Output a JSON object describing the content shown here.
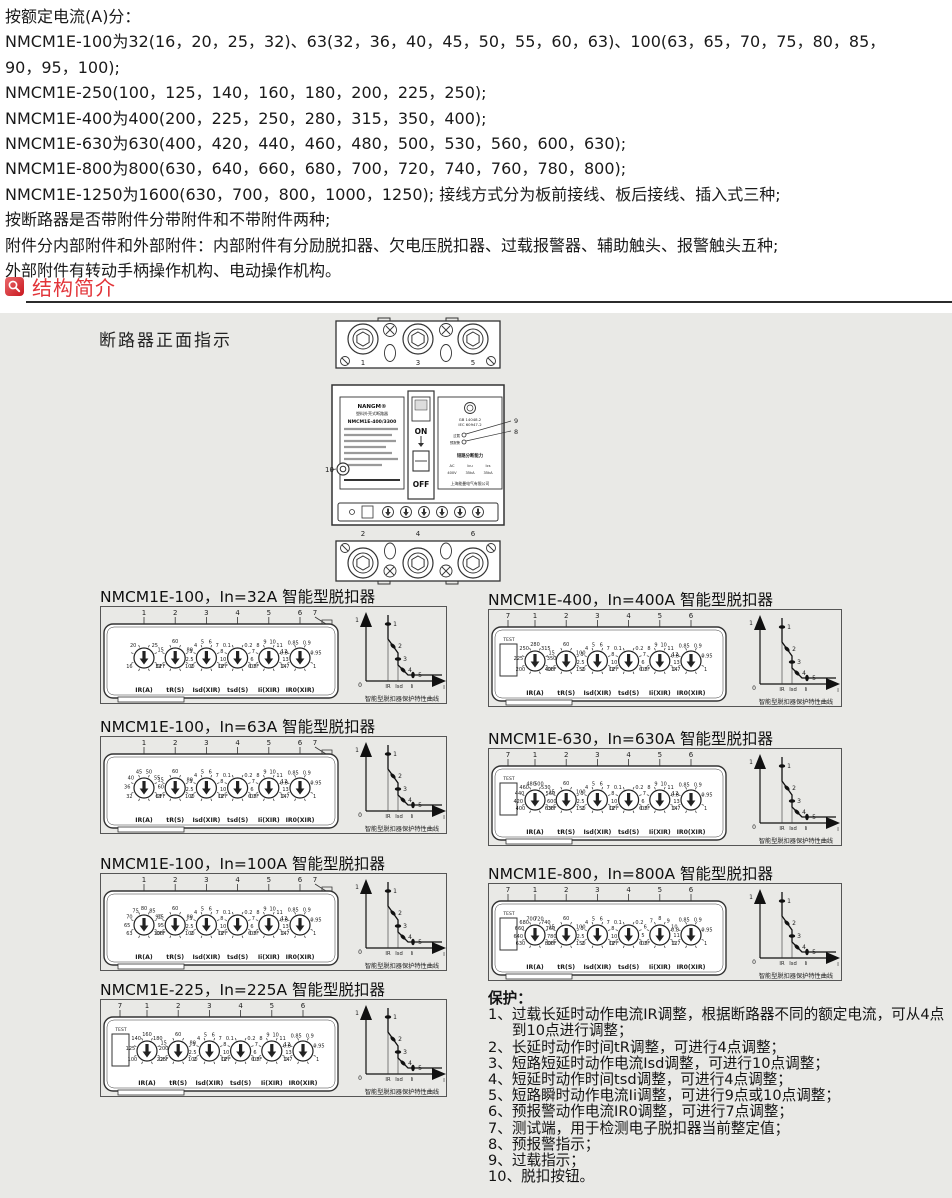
{
  "intro": {
    "lines": [
      "按额定电流(A)分：",
      "NMCM1E-100为32(16，20，25，32)、63(32，36，40，45，50，55，60，63)、100(63，65，70，75，80，85，",
      "90，95，100);",
      "NMCM1E-250(100，125，140，160，180，200，225，250);",
      "NMCM1E-400为400(200，225，250，280，315，350，400);",
      "NMCM1E-630为630(400，420，440，460，480，500，530，560，600，630);",
      "NMCM1E-800为800(630，640，660，680，700，720，740，760，780，800);",
      "NMCM1E-1250为1600(630，700，800，1000，1250); 接线方式分为板前接线、板后接线、插入式三种;",
      "按断路器是否带附件分带附件和不带附件两种;",
      "附件分内部附件和外部附件：内部附件有分励脱扣器、欠电压脱扣器、过载报警器、辅助触头、报警触头五种;",
      "外部附件有转动手柄操作机构、电动操作机构。"
    ]
  },
  "section": {
    "title": "结构简介"
  },
  "gray": {
    "breaker_caption": "断路器正面指示",
    "breaker": {
      "top_terminals": [
        "1",
        "3",
        "5"
      ],
      "bottom_terminals": [
        "2",
        "4",
        "6"
      ],
      "brand": "NANGM®",
      "type_name": "塑料外壳式断路器",
      "model": "NMCM1E-400/3300",
      "on": "ON",
      "off": "OFF",
      "std1": "GB 14048.2",
      "std2": "IEC 60947-2",
      "led_labels": [
        "过载",
        "预报警"
      ],
      "breaking_title": "短路分断能力",
      "breaking_cols": [
        "AC",
        "Icu",
        "Ics"
      ],
      "breaking_vals": [
        "400V",
        "35kA",
        "35kA"
      ],
      "company": "上海能曼电气有限公司",
      "callout_left": "10",
      "callout_right_top": "9",
      "callout_right_bottom": "8"
    },
    "curve": {
      "y_top": "1",
      "origin": "0",
      "x_ticks": [
        "IR",
        "Isd",
        "Ii"
      ],
      "x_label": "I",
      "markers": [
        "1",
        "2",
        "3",
        "4",
        "5"
      ],
      "caption": "智能型脱扣器保护特性曲线"
    },
    "panels": [
      {
        "title": "NMCM1E-100，In=32A 智能型脱扣器",
        "has_test": false,
        "callouts": [
          "1",
          "2",
          "3",
          "4",
          "5",
          "6",
          "7"
        ],
        "dials": [
          {
            "label": "IR(A)",
            "values": [
              "16",
              "20",
              "25",
              "32"
            ]
          },
          {
            "label": "tR(S)",
            "values": [
              "OFF",
              "15",
              "60",
              "80",
              "100"
            ]
          },
          {
            "label": "Isd(XIR)",
            "values": [
              "2",
              "2.5",
              "3",
              "4",
              "5",
              "6",
              "7",
              "8",
              "10",
              "12"
            ]
          },
          {
            "label": "tsd(S)",
            "values": [
              "OFF",
              "0.1",
              "0.2",
              "0.3"
            ]
          },
          {
            "label": "Ii(XIR)",
            "values": [
              "OFF",
              "6",
              "7",
              "8",
              "9",
              "10",
              "11",
              "12",
              "13",
              "14"
            ]
          },
          {
            "label": "IR0(XIR)",
            "values": [
              "0.7",
              "0.8",
              "0.85",
              "0.9",
              "0.95",
              "1"
            ]
          }
        ]
      },
      {
        "title": "NMCM1E-100，In=63A 智能型脱扣器",
        "has_test": false,
        "callouts": [
          "1",
          "2",
          "3",
          "4",
          "5",
          "6",
          "7"
        ],
        "dials": [
          {
            "label": "IR(A)",
            "values": [
              "32",
              "36",
              "40",
              "45",
              "50",
              "55",
              "60",
              "63"
            ]
          },
          {
            "label": "tR(S)",
            "values": [
              "OFF",
              "15",
              "60",
              "80",
              "100"
            ]
          },
          {
            "label": "Isd(XIR)",
            "values": [
              "2",
              "2.5",
              "3",
              "4",
              "5",
              "6",
              "7",
              "8",
              "10",
              "12"
            ]
          },
          {
            "label": "tsd(S)",
            "values": [
              "OFF",
              "0.1",
              "0.2",
              "0.3"
            ]
          },
          {
            "label": "Ii(XIR)",
            "values": [
              "OFF",
              "6",
              "7",
              "8",
              "9",
              "10",
              "11",
              "12",
              "13",
              "14"
            ]
          },
          {
            "label": "IR0(XIR)",
            "values": [
              "0.7",
              "0.8",
              "0.85",
              "0.9",
              "0.95",
              "1"
            ]
          }
        ]
      },
      {
        "title": "NMCM1E-100，In=100A 智能型脱扣器",
        "has_test": false,
        "callouts": [
          "1",
          "2",
          "3",
          "4",
          "5",
          "6",
          "7"
        ],
        "dials": [
          {
            "label": "IR(A)",
            "values": [
              "63",
              "65",
              "70",
              "75",
              "80",
              "85",
              "90",
              "95",
              "100"
            ]
          },
          {
            "label": "tR(S)",
            "values": [
              "OFF",
              "15",
              "60",
              "80",
              "100"
            ]
          },
          {
            "label": "Isd(XIR)",
            "values": [
              "2",
              "2.5",
              "3",
              "4",
              "5",
              "6",
              "7",
              "8",
              "10",
              "12"
            ]
          },
          {
            "label": "tsd(S)",
            "values": [
              "OFF",
              "0.1",
              "0.2",
              "0.3"
            ]
          },
          {
            "label": "Ii(XIR)",
            "values": [
              "OFF",
              "6",
              "7",
              "8",
              "9",
              "10",
              "11",
              "12",
              "13",
              "14"
            ]
          },
          {
            "label": "IR0(XIR)",
            "values": [
              "0.7",
              "0.8",
              "0.85",
              "0.9",
              "0.95",
              "1"
            ]
          }
        ]
      },
      {
        "title": "NMCM1E-225，In=225A 智能型脱扣器",
        "has_test": true,
        "test_label": "TEST",
        "callouts": [
          "7",
          "1",
          "2",
          "3",
          "4",
          "5",
          "6"
        ],
        "dials": [
          {
            "label": "IR(A)",
            "values": [
              "100",
              "125",
              "140",
              "160",
              "180",
              "200",
              "225"
            ]
          },
          {
            "label": "tR(S)",
            "values": [
              "OFF",
              "15",
              "60",
              "80",
              "100"
            ]
          },
          {
            "label": "Isd(XIR)",
            "values": [
              "2",
              "2.5",
              "3",
              "4",
              "5",
              "6",
              "7",
              "8",
              "10",
              "12"
            ]
          },
          {
            "label": "tsd(S)",
            "values": [
              "OFF",
              "0.1",
              "0.2",
              "0.3"
            ]
          },
          {
            "label": "Ii(XIR)",
            "values": [
              "OFF",
              "6",
              "7",
              "8",
              "9",
              "10",
              "11",
              "12",
              "13",
              "14"
            ]
          },
          {
            "label": "IR0(XIR)",
            "values": [
              "0.7",
              "0.8",
              "0.85",
              "0.9",
              "0.95",
              "1"
            ]
          }
        ]
      },
      {
        "title": "NMCM1E-400，In=400A 智能型脱扣器",
        "has_test": true,
        "test_label": "TEST",
        "callouts": [
          "7",
          "1",
          "2",
          "3",
          "4",
          "5",
          "6"
        ],
        "dials": [
          {
            "label": "IR(A)",
            "values": [
              "200",
              "225",
              "250",
              "280",
              "315",
              "350",
              "400"
            ]
          },
          {
            "label": "tR(S)",
            "values": [
              "OFF",
              "15",
              "60",
              "100",
              "150"
            ]
          },
          {
            "label": "Isd(XIR)",
            "values": [
              "2",
              "2.5",
              "3",
              "4",
              "5",
              "6",
              "7",
              "8",
              "10",
              "12"
            ]
          },
          {
            "label": "tsd(S)",
            "values": [
              "OFF",
              "0.1",
              "0.2",
              "0.3"
            ]
          },
          {
            "label": "Ii(XIR)",
            "values": [
              "OFF",
              "6",
              "7",
              "8",
              "9",
              "10",
              "11",
              "12",
              "13",
              "14"
            ]
          },
          {
            "label": "IR0(XIR)",
            "values": [
              "0.7",
              "0.8",
              "0.85",
              "0.9",
              "0.95",
              "1"
            ]
          }
        ]
      },
      {
        "title": "NMCM1E-630，In=630A 智能型脱扣器",
        "has_test": true,
        "test_label": "TEST",
        "callouts": [
          "7",
          "1",
          "2",
          "3",
          "4",
          "5",
          "6"
        ],
        "dials": [
          {
            "label": "IR(A)",
            "values": [
              "400",
              "420",
              "440",
              "460",
              "480",
              "500",
              "530",
              "560",
              "600",
              "630"
            ]
          },
          {
            "label": "tR(S)",
            "values": [
              "OFF",
              "15",
              "60",
              "100",
              "150"
            ]
          },
          {
            "label": "Isd(XIR)",
            "values": [
              "2",
              "2.5",
              "3",
              "4",
              "5",
              "6",
              "7",
              "8",
              "10",
              "12"
            ]
          },
          {
            "label": "tsd(S)",
            "values": [
              "OFF",
              "0.1",
              "0.2",
              "0.3"
            ]
          },
          {
            "label": "Ii(XIR)",
            "values": [
              "OFF",
              "6",
              "7",
              "8",
              "9",
              "10",
              "11",
              "12",
              "13",
              "14"
            ]
          },
          {
            "label": "IR0(XIR)",
            "values": [
              "0.7",
              "0.8",
              "0.85",
              "0.9",
              "0.95",
              "1"
            ]
          }
        ]
      },
      {
        "title": "NMCM1E-800，In=800A 智能型脱扣器",
        "has_test": true,
        "test_label": "TEST",
        "callouts": [
          "7",
          "1",
          "2",
          "3",
          "4",
          "5",
          "6"
        ],
        "dials": [
          {
            "label": "IR(A)",
            "values": [
              "630",
              "640",
              "660",
              "680",
              "700",
              "720",
              "740",
              "760",
              "780",
              "800"
            ]
          },
          {
            "label": "tR(S)",
            "values": [
              "OFF",
              "15",
              "60",
              "100",
              "150"
            ]
          },
          {
            "label": "Isd(XIR)",
            "values": [
              "2",
              "2.5",
              "3",
              "4",
              "5",
              "6",
              "7",
              "8",
              "10",
              "12"
            ]
          },
          {
            "label": "tsd(S)",
            "values": [
              "OFF",
              "0.1",
              "0.2",
              "0.3"
            ]
          },
          {
            "label": "Ii(XIR)",
            "values": [
              "OFF",
              "5",
              "6",
              "7",
              "8",
              "9",
              "10",
              "11",
              "12"
            ]
          },
          {
            "label": "IR0(XIR)",
            "values": [
              "0.7",
              "0.8",
              "0.85",
              "0.9",
              "0.95",
              "1"
            ]
          }
        ]
      }
    ],
    "protection": {
      "title": "保护：",
      "items": [
        {
          "no": "1、",
          "text": "过载长延时动作电流IR调整，根据断路器不同的额定电流，可从4点到10点进行调整；"
        },
        {
          "no": "2、",
          "text": "长延时动作时间tR调整，可进行4点调整；"
        },
        {
          "no": "3、",
          "text": "短路短延时动作电流Isd调整，可进行10点调整；"
        },
        {
          "no": "4、",
          "text": "短延时动作时间tsd调整，可进行4点调整；"
        },
        {
          "no": "5、",
          "text": "短路瞬时动作电流Ii调整，可进行9点或10点调整；"
        },
        {
          "no": "6、",
          "text": "预报警动作电流IR0调整，可进行7点调整；"
        },
        {
          "no": "7、",
          "text": "测试端，用于检测电子脱扣器当前整定值；"
        },
        {
          "no": "8、",
          "text": "预报警指示；"
        },
        {
          "no": "9、",
          "text": "过载指示；"
        },
        {
          "no": "10、",
          "text": "脱扣按钮。"
        }
      ]
    }
  }
}
